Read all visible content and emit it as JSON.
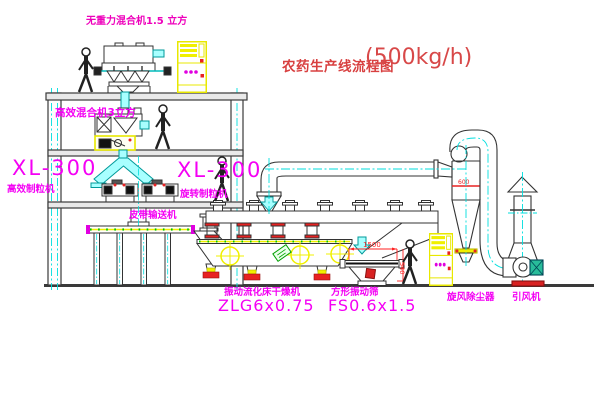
{
  "title": {
    "name": "农药生产线流程图",
    "capacity": "(500kg/h)"
  },
  "labels": {
    "top_mixer": "无重力混合机1.5 立方",
    "floor2_mixer": "高效混合机3立方",
    "left_model": "XL-300",
    "left_machine": "高效制粒机",
    "mid_model": "XL-300",
    "mid_machine": "旋转制粒机",
    "belt_conveyor": "皮带输送机",
    "dryer": "振动流化床干燥机",
    "dryer_model": "ZLG6x0.75",
    "screen": "方形振动筛",
    "screen_model": "FS0.6x1.5",
    "cyclone": "旋风除尘器",
    "fan": "引风机"
  },
  "dims": {
    "screen_length": "1500",
    "screen_height": "540",
    "cyclone_inlet": "600"
  },
  "colors": {
    "label_magenta": "#f400f4",
    "title_red": "#d84040",
    "dimension_red": "#ff2222",
    "centerline_cyan": "#00dede",
    "highlight_yellow": "#f0f000",
    "structure_gray": "#3a3a3a"
  }
}
